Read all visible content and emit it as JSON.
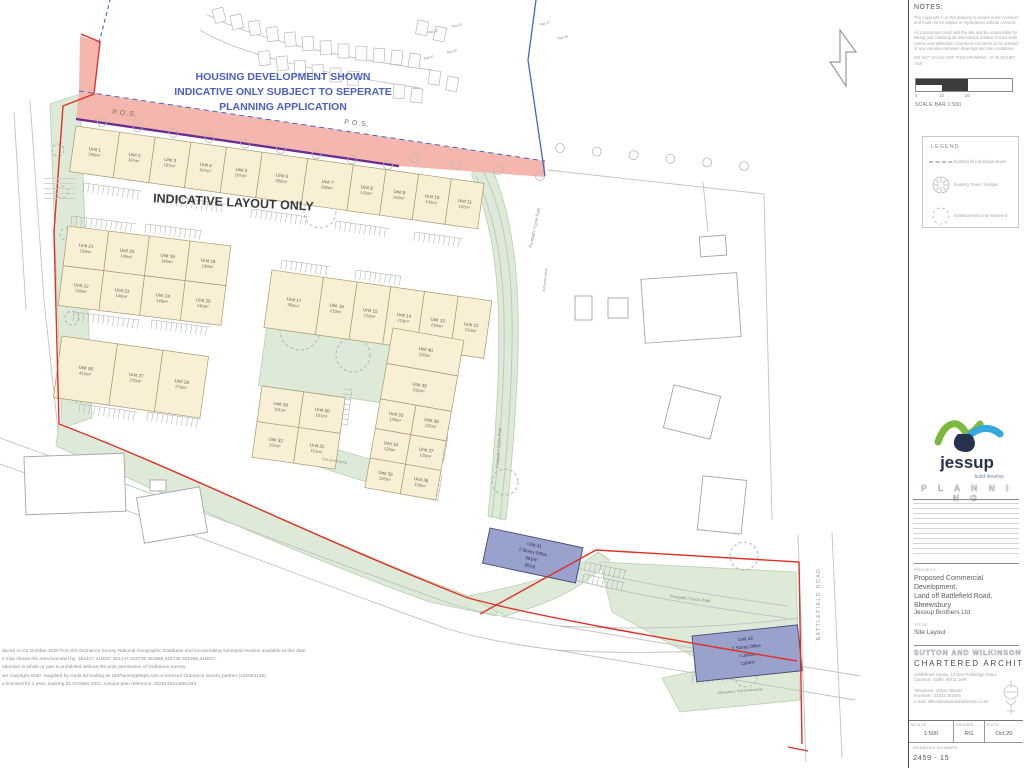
{
  "plan": {
    "banner": [
      "HOUSING DEVELOPMENT SHOWN",
      "INDICATIVE ONLY SUBJECT TO SEPERATE",
      "PLANNING APPLICATION"
    ],
    "indicative": "INDICATIVE LAYOUT ONLY",
    "pos": "P.O.S.",
    "footpath": "Footpath / Cycle Path",
    "road_label": "BATTLEFIELD ROAD",
    "soft_landscaping": "Soft landscaping",
    "attenuation": "Attenuation / Soft landscaping",
    "plot_labels": [
      "Plot 43",
      "Plot 42",
      "Plot 40",
      "Plot 41",
      "Plot 37",
      "Plot 38"
    ],
    "units": [
      {
        "label": "Unit 1",
        "area": "240m²"
      },
      {
        "label": "Unit 2",
        "area": "167m²"
      },
      {
        "label": "Unit 3",
        "area": "167m²"
      },
      {
        "label": "Unit 4",
        "area": "167m²"
      },
      {
        "label": "Unit 5",
        "area": "167m²"
      },
      {
        "label": "Unit 6",
        "area": "280m²"
      },
      {
        "label": "Unit 7",
        "area": "280m²"
      },
      {
        "label": "Unit 8",
        "area": "142m²"
      },
      {
        "label": "Unit 9",
        "area": "142m²"
      },
      {
        "label": "Unit 10",
        "area": "142m²"
      },
      {
        "label": "Unit 11",
        "area": "142m²"
      },
      {
        "label": "Unit 12",
        "area": "210m²"
      },
      {
        "label": "Unit 13",
        "area": "210m²"
      },
      {
        "label": "Unit 14",
        "area": "210m²"
      },
      {
        "label": "Unit 15",
        "area": "210m²"
      },
      {
        "label": "Unit 16",
        "area": "210m²"
      },
      {
        "label": "Unit 17",
        "area": "302m²"
      },
      {
        "label": "Unit 18",
        "area": "140m²"
      },
      {
        "label": "Unit 19",
        "area": "140m²"
      },
      {
        "label": "Unit 20",
        "area": "140m²"
      },
      {
        "label": "Unit 21",
        "area": "139m²"
      },
      {
        "label": "Unit 22",
        "area": "138m²"
      },
      {
        "label": "Unit 23",
        "area": "140m²"
      },
      {
        "label": "Unit 24",
        "area": "140m²"
      },
      {
        "label": "Unit 25",
        "area": "140m²"
      },
      {
        "label": "Unit 26",
        "area": "415m²"
      },
      {
        "label": "Unit 27",
        "area": "270m²"
      },
      {
        "label": "Unit 28",
        "area": "270m²"
      },
      {
        "label": "Unit 29",
        "area": "151m²"
      },
      {
        "label": "Unit 30",
        "area": "151m²"
      },
      {
        "label": "Unit 31",
        "area": "151m²"
      },
      {
        "label": "Unit 32",
        "area": "151m²"
      },
      {
        "label": "Unit 33",
        "area": "120m²"
      },
      {
        "label": "Unit 34",
        "area": "125m²"
      },
      {
        "label": "Unit 35",
        "area": "125m²"
      },
      {
        "label": "Unit 36",
        "area": "120m²"
      },
      {
        "label": "Unit 37",
        "area": "125m²"
      },
      {
        "label": "Unit 38",
        "area": "125m²"
      },
      {
        "label": "Unit 39",
        "area": "232m²"
      },
      {
        "label": "Unit 40",
        "area": "232m²"
      }
    ],
    "unit41": [
      "Unit 41",
      "2 Storey Office",
      "881m²",
      "(B1a)"
    ],
    "unit42": [
      "Unit 42",
      "2 Storey Office",
      "/ Leisure",
      "1164m²"
    ],
    "os_lines": [
      "duced on 01 October 2020 from the Ordnance Survey National Geographic Database and incorporating surveyed revision available at this date.",
      "s map shows the area bounded by: 351447,316037 351447,316739 351589,316739 351589,316037.",
      "oduction in whole or part is prohibited without the prior permission of Ordnance Survey.",
      "wn copyright 2020. Supplied by copla ltd trading as UKPlanningMaps.com a licensed Ordnance Survey partner (100054135).",
      "a licensed for 1 year, expiring 01 October 2021. Unique plan reference: x0z5146414691344"
    ]
  },
  "panel": {
    "notes_title": "NOTES:",
    "notes": [
      "The copyright © of this drawing is vested in the Architect and must not be copied or reproduced without consent.",
      "All Contractors must visit the site and be responsible for taking and checking all dimensions relative to their work. Sutton and Wilkinson Chartered Architects to be advised of any variation between drawings and site conditions.",
      "DO NOT SCALE OFF THIS DRAWING - IF IN DOUBT ASK"
    ],
    "scalebar": {
      "t0": "0",
      "t10": "10",
      "t20": "20",
      "label": "SCALE BAR 1:500"
    },
    "legend": {
      "title": "LEGEND",
      "items": [
        "Existing foul drainage sewer",
        "Existing Trees / Hedges",
        "Existing trees to be removed"
      ]
    },
    "logo": {
      "name": "jessup",
      "tagline": "build develop"
    },
    "planning_header": "P L A N N I N G",
    "project": {
      "label": "PROJECT",
      "lines": [
        "Proposed Commercial Development,",
        "Land off Battlefield Road,",
        "Shrewsbury"
      ]
    },
    "client": {
      "label": "CLIENT",
      "value": "Jessup Brothers Ltd"
    },
    "title": {
      "label": "TITLE",
      "value": "Site Layout"
    },
    "firm": {
      "name": "SUTTON AND WILKINSON",
      "subtitle": "CHARTERED ARCHITECTS",
      "address1": "Oddfellows House, 13 New Penkridge Road,",
      "address2": "Cannock, Staffs, WS11 1HR",
      "tel": "Telephone: 01543 466441",
      "fax": "Facsimile: 01543 462446",
      "email": "e-mail: office@suttonandwilkinson.co.uk"
    },
    "meta": {
      "scale_label": "SCALE",
      "scale": "1:500",
      "drawn_label": "DRAWN",
      "drawn": "RG",
      "date_label": "DATE",
      "date": "Oct.20",
      "dwg_label": "DRAWING NUMBER",
      "dwg": "2459 - 15"
    },
    "colors": {
      "accent_green": "#7cb93e",
      "accent_blue": "#35a8e0",
      "site_red": "#e03128",
      "pos_pink": "#f5b6ae",
      "boundary_purple": "#6a2d91",
      "plan_blue": "#4c60bf"
    }
  }
}
